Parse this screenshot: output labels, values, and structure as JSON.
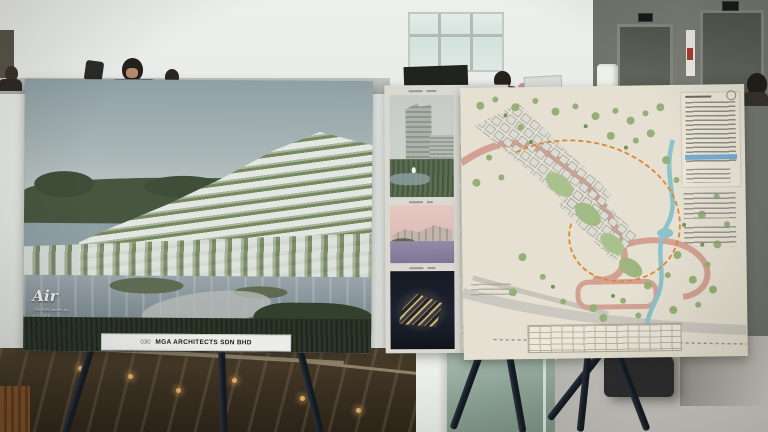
{
  "left_board": {
    "logo_text": "Air",
    "tagline_line_1": "The AIR above us",
    "tagline_line_2": "in … AIR …",
    "entry_number": "030",
    "firm_name": "MGA ARCHITECTS SDN BHD"
  }
}
